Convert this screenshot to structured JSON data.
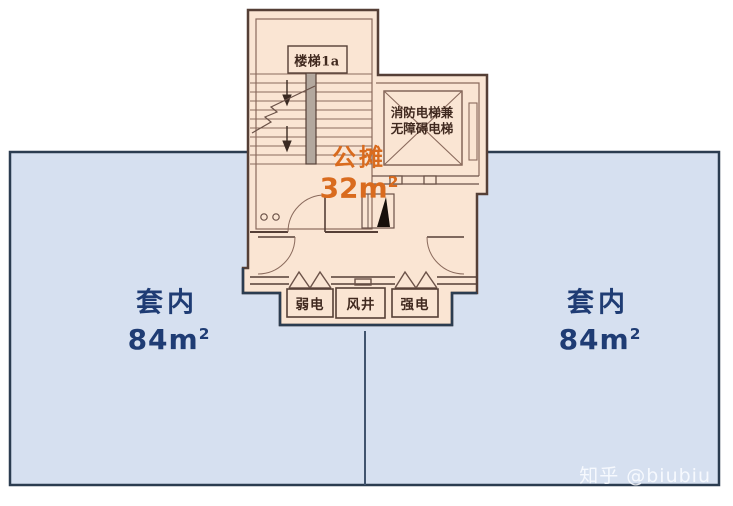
{
  "core": {
    "stair_label": "楼梯1a",
    "elevator_label": [
      "消防电梯兼",
      "无障碍电梯"
    ],
    "shared": {
      "label": "公摊",
      "value": "32",
      "unit": "m",
      "power": "2"
    },
    "shafts": [
      {
        "label": "弱电"
      },
      {
        "label": "风井"
      },
      {
        "label": "强电"
      }
    ]
  },
  "units": {
    "left": {
      "label": "套内",
      "value": "84",
      "unit": "m",
      "power": "2"
    },
    "right": {
      "label": "套内",
      "value": "84",
      "unit": "m",
      "power": "2"
    }
  },
  "watermark": "知乎 @biubiu",
  "colors": {
    "unit_fill": "#d6e0f0",
    "unit_border": "#2b3c50",
    "core_fill": "#fae5d3",
    "wall": "#553f36",
    "wall_light": "#8a6a5c",
    "shared_accent": "#d96b1e",
    "unit_text": "#1f3c74"
  }
}
